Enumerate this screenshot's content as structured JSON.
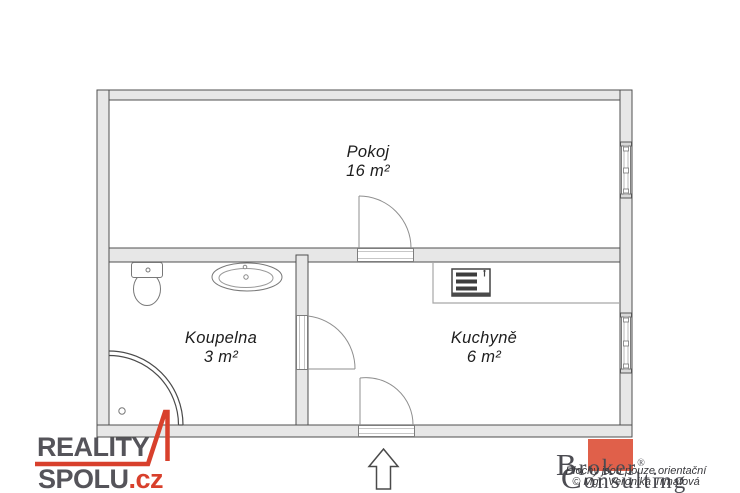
{
  "floorplan": {
    "rooms": [
      {
        "name": "Pokoj",
        "area": "16 m²"
      },
      {
        "name": "Koupelna",
        "area": "3 m²"
      },
      {
        "name": "Kuchyně",
        "area": "6 m²"
      }
    ],
    "icon_names": [
      "entrance-arrow-icon",
      "door-swing-icon",
      "window-icon",
      "toilet-icon",
      "sink-icon",
      "shower-icon",
      "stove-icon",
      "kitchen-counter"
    ],
    "wall_fill_color": "#e7e7e7",
    "wall_outline_color": "#4f4f4f"
  },
  "branding": {
    "reality_spolu": {
      "word1": "REALITY",
      "word2": "SPOLU",
      "tld": ".cz",
      "accent_color": "#d8402c",
      "text_color": "#55545a"
    },
    "broker_consulting": {
      "word1": "Broker",
      "registered": "®",
      "word2": "Consulting",
      "square_color": "#e0604a",
      "text_color": "#4c4c52"
    },
    "disclaimer": {
      "line1": "Plochy jsou pouze orientační",
      "line2": "© Mgr. Veronika Trmatová"
    }
  }
}
